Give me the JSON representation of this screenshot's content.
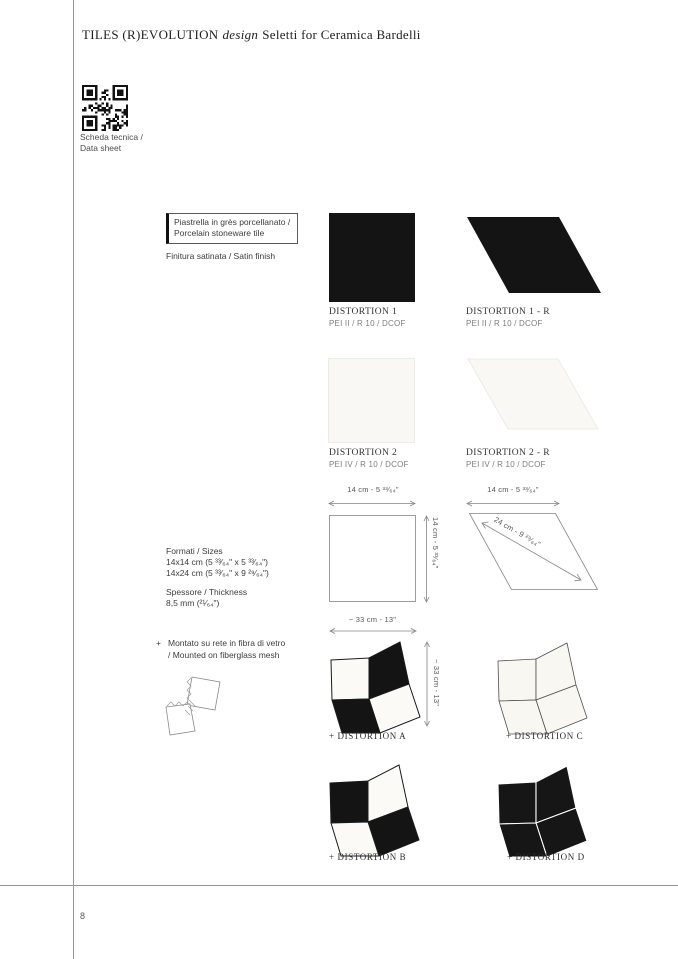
{
  "colors": {
    "tile_black": "#141414",
    "tile_white": "#f9f8f4",
    "rule_gray": "#979797",
    "dimension_gray": "#808080"
  },
  "header": {
    "brand": "TILES (R)EVOLUTION",
    "design_word": "design",
    "byline": "Seletti for Ceramica Bardelli"
  },
  "datasheet": {
    "qr_icon": "qr-code",
    "caption_it": "Scheda tecnica /",
    "caption_en": "Data sheet"
  },
  "material": {
    "box_it": "Piastrella in grès porcellanato /",
    "box_en": "Porcelain stoneware tile",
    "finish": "Finitura satinata / Satin finish"
  },
  "products": [
    {
      "name": "DISTORTION 1",
      "specs": "PEI II / R 10 / DCOF",
      "shape": "square",
      "color": "black"
    },
    {
      "name": "DISTORTION 1 - R",
      "specs": "PEI II / R 10 / DCOF",
      "shape": "parallelogram",
      "color": "black"
    },
    {
      "name": "DISTORTION 2",
      "specs": "PEI IV / R 10 / DCOF",
      "shape": "square",
      "color": "white"
    },
    {
      "name": "DISTORTION 2 - R",
      "specs": "PEI IV / R 10 / DCOF",
      "shape": "parallelogram",
      "color": "white"
    }
  ],
  "sizes": {
    "heading": "Formati / Sizes",
    "row1": "14x14 cm (5 ³³⁄₆₄\" x 5 ³³⁄₆₄\")",
    "row2": "14x24 cm (5 ³³⁄₆₄\" x 9 ²⁹⁄₆₄\")",
    "thickness_heading": "Spessore / Thickness",
    "thickness": "8,5 mm (²¹⁄₆₄\")"
  },
  "dims": {
    "tile_edge": "14 cm - 5 ³³⁄₆₄\"",
    "tile_diagonal": "24 cm - 9 ²⁹⁄₆₄\"",
    "composition": "~ 33 cm - 13\""
  },
  "mesh_note": {
    "plus": "+",
    "line_it": "Montato su rete in fibra di vetro",
    "line_en": "/ Mounted on fiberglass mesh"
  },
  "compositions": [
    {
      "label": "+ DISTORTION A"
    },
    {
      "label": "+ DISTORTION C"
    },
    {
      "label": "+ DISTORTION B"
    },
    {
      "label": "+ DISTORTION D"
    }
  ],
  "footer": {
    "page_number": "8"
  }
}
